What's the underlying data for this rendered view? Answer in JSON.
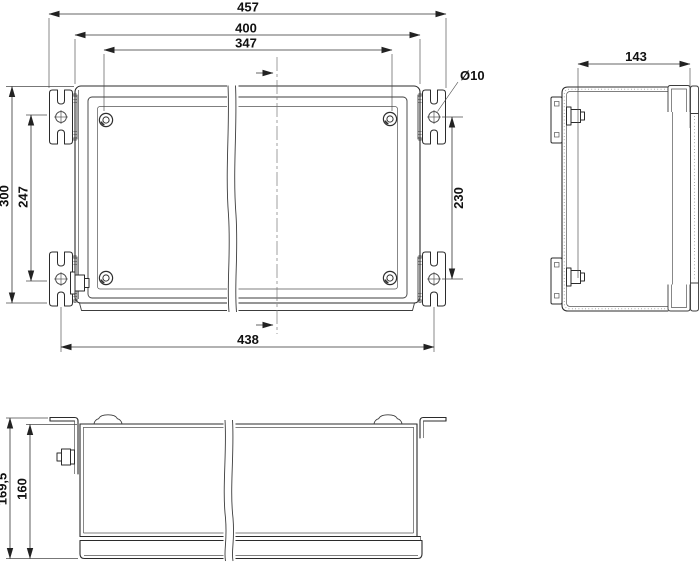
{
  "drawing": {
    "type": "technical-drawing",
    "views": [
      "front-view",
      "side-view",
      "bottom-view"
    ]
  },
  "dims": {
    "front": {
      "overall_width": "457",
      "body_width": "400",
      "inner_width": "347",
      "body_height": "300",
      "inner_height": "247",
      "hole_spacing_vertical": "230",
      "hole_spacing_horizontal": "438",
      "hole_diameter": "Ø10"
    },
    "side": {
      "depth": "143"
    },
    "bottom": {
      "overall_height": "169,5",
      "body_height": "160"
    }
  },
  "colors": {
    "background": "#ffffff",
    "line": "#2b2b2b",
    "dimension_line": "#333333",
    "text": "#111111",
    "stipple": "#8a8a8a"
  }
}
